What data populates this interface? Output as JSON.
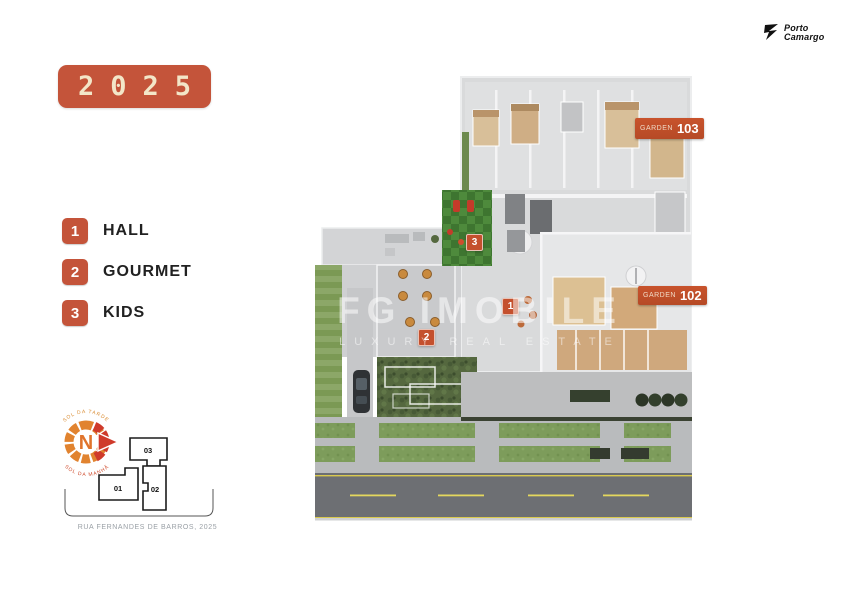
{
  "year_badge": {
    "text": "2025",
    "color": "#c4543a"
  },
  "brand": {
    "name_line1": "Porto",
    "name_line2": "Camargo"
  },
  "legend": {
    "items": [
      {
        "number": "1",
        "label": "HALL"
      },
      {
        "number": "2",
        "label": "GOURMET"
      },
      {
        "number": "3",
        "label": "KIDS"
      }
    ],
    "badge_color": "#c4543a"
  },
  "compass": {
    "letter": "N",
    "top_label": "SOL DA TARDE",
    "bottom_label": "SOL DA MANHÃ"
  },
  "keyplan": {
    "units": [
      "01",
      "02",
      "03"
    ],
    "street_label": "RUA FERNANDES DE BARROS, 2025"
  },
  "plan": {
    "garden_badges": [
      {
        "prefix": "GARDEN",
        "number": "103"
      },
      {
        "prefix": "GARDEN",
        "number": "102"
      }
    ],
    "markers": [
      "1",
      "2",
      "3"
    ],
    "badge_color": "#c2522c"
  },
  "watermark": {
    "line1": "FG IMOBILE",
    "line2": "LUXURY REAL ESTATE"
  }
}
